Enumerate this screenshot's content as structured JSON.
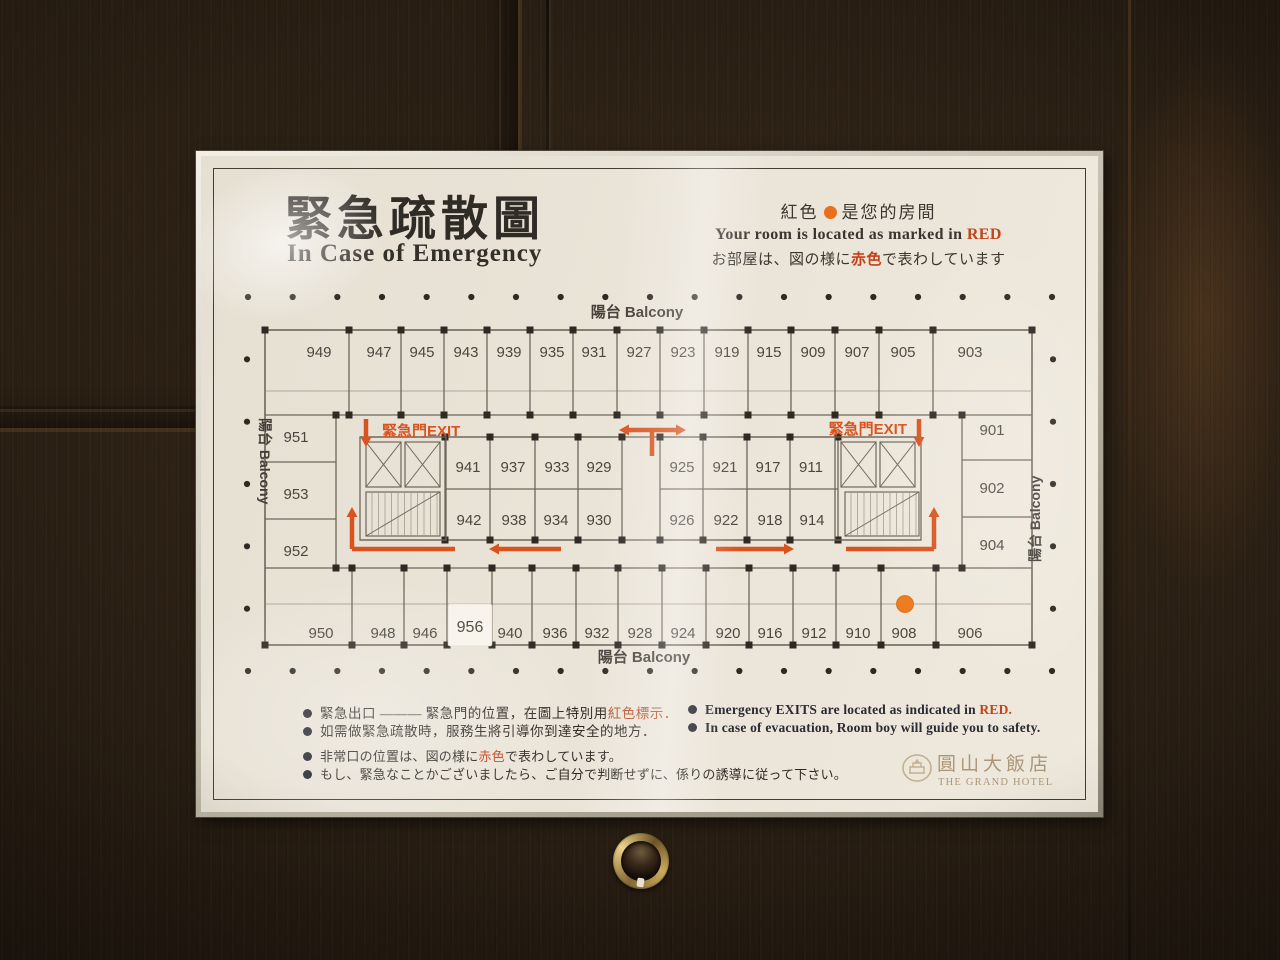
{
  "colors": {
    "accent_orange": "#d9531e",
    "marker_orange": "#ed7a1f",
    "wall": "#6f665a",
    "wall_light": "#9a9184",
    "ink_dark": "#2e2923",
    "number_ink": "#4c463e",
    "label_ink": "#45403a",
    "gold": "#ab9778",
    "red_text": "#c2441a"
  },
  "header": {
    "title_zh": "緊急疏散圖",
    "title_en": "In Case of Emergency",
    "note_line1_pre": "紅色",
    "note_line1_post": "是您的房間",
    "note_line2_pre": "Your room is located as marked in",
    "note_line2_accent": "RED",
    "note_line3_pre": "お部屋は、図の様に",
    "note_line3_accent": "赤色",
    "note_line3_post": "で表わしています"
  },
  "plan": {
    "balcony_top": "陽台 Balcony",
    "balcony_bottom": "陽台 Balcony",
    "balcony_left": "陽台 Balcony",
    "balcony_right": "陽台 Balcony",
    "exit_label_left": "緊急門EXIT",
    "exit_label_right": "緊急門EXIT",
    "rooms_top": [
      "949",
      "947",
      "945",
      "943",
      "939",
      "935",
      "931",
      "927",
      "923",
      "919",
      "915",
      "909",
      "907",
      "905",
      "903"
    ],
    "rooms_bottom": [
      "950",
      "948",
      "946",
      "956",
      "940",
      "936",
      "932",
      "928",
      "924",
      "920",
      "916",
      "912",
      "910",
      "908",
      "906"
    ],
    "rooms_left": [
      "951",
      "953",
      "952"
    ],
    "rooms_right": [
      "901",
      "902",
      "904"
    ],
    "rooms_inner_top_left": [
      "941",
      "937",
      "933",
      "929"
    ],
    "rooms_inner_bottom_left": [
      "942",
      "938",
      "934",
      "930"
    ],
    "rooms_inner_top_right": [
      "925",
      "921",
      "917",
      "911"
    ],
    "rooms_inner_bottom_right": [
      "926",
      "922",
      "918",
      "914"
    ],
    "marked_room": "908",
    "sticker_room": "956"
  },
  "legend": {
    "zh1_pre": "緊急出口 ——— 緊急門的位置，在圖上特別用",
    "zh1_accent": "紅色標示．",
    "zh2": "如需做緊急疏散時，服務生將引導你到達安全的地方．",
    "jp1_pre": "非常口の位置は、図の様に",
    "jp1_accent": "赤色",
    "jp1_post": "で表わしています。",
    "jp2": "もし、緊急なことかございましたら、ご自分で判断せずに、係りの誘導に従って下さい。",
    "en1_pre": "Emergency EXITS are located as indicated in",
    "en1_accent": "RED.",
    "en2": "In case of evacuation, Room boy will guide you to safety."
  },
  "logo": {
    "zh": "圓山大飯店",
    "en": "THE GRAND HOTEL"
  }
}
